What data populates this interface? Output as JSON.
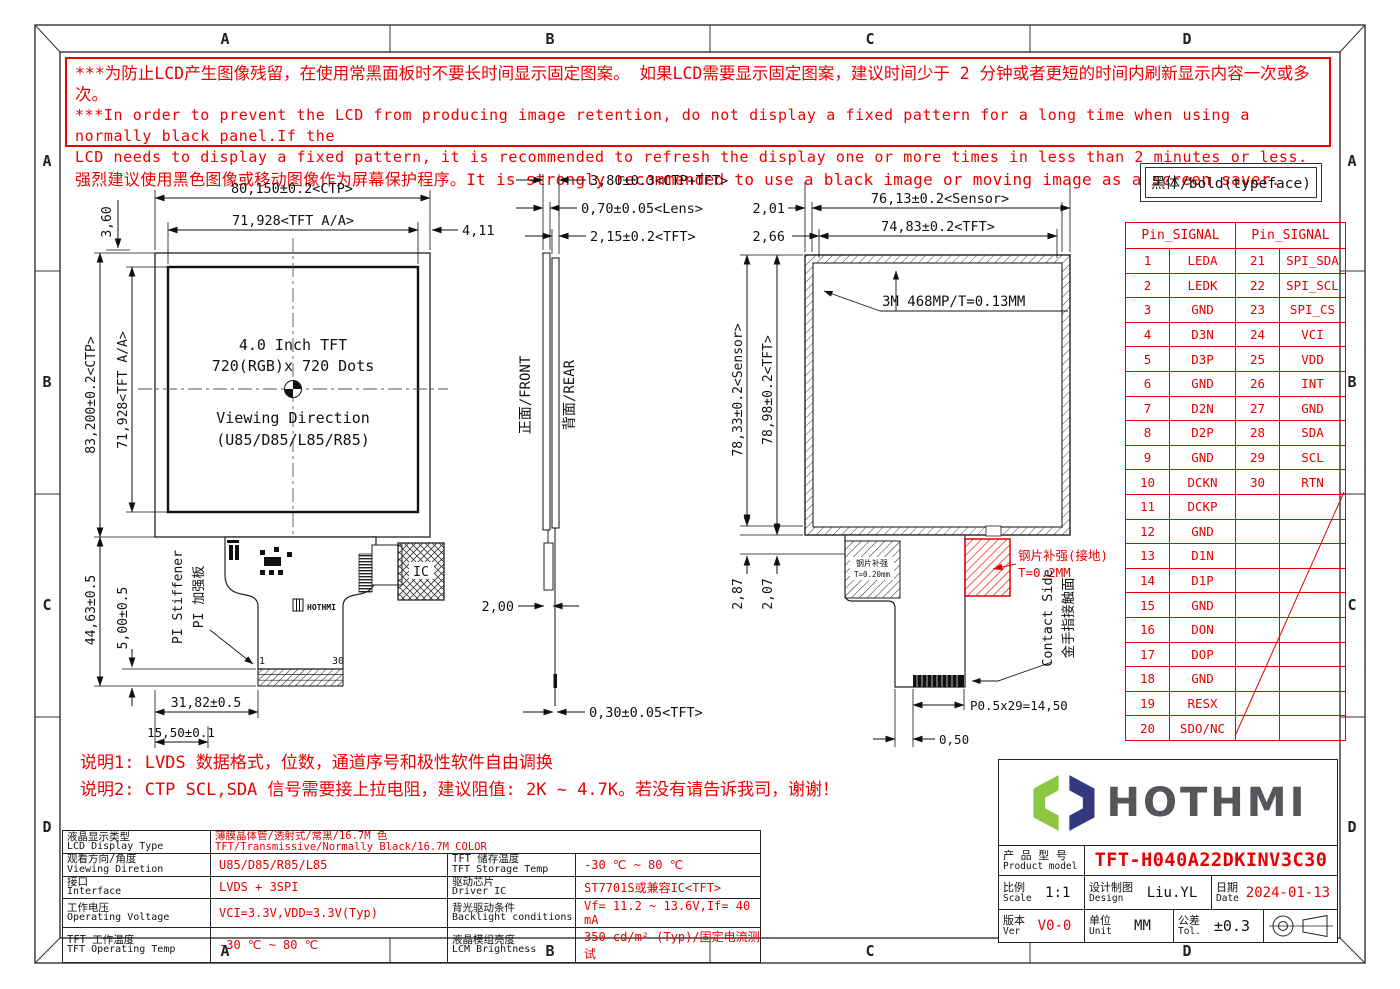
{
  "colors": {
    "red": "#e60000",
    "line": "#111111",
    "logo_green": "#8dc63f",
    "logo_navy": "#35387e",
    "logo_gray": "#55565a"
  },
  "zones": [
    "A",
    "B",
    "C",
    "D"
  ],
  "warning": {
    "lines": [
      "***为防止LCD产生图像残留，在使用常黑面板时不要长时间显示固定图案。 如果LCD需要显示固定图案，建议时间少于 2 分钟或者更短的时间内刷新显示内容一次或多次。",
      "***In order to prevent the LCD from producing image retention, do not display a fixed pattern for a long time when using a normally black panel.If the",
      "LCD needs to display a fixed pattern, it is recommended to refresh the display one or more times in less than 2 minutes or less.",
      "强烈建议使用黑色图像或移动图像作为屏幕保护程序。It is strongly recommended to use a black image or moving image as a screen saver."
    ]
  },
  "typeface_note": "黑体/bold(typeface)",
  "front_view": {
    "display_line1": "4.0 Inch TFT",
    "display_line2": "720(RGB)x 720 Dots",
    "viewing_line1": "Viewing Direction",
    "viewing_line2": "(U85/D85/L85/R85)",
    "stiffener_en": "PI Stiffener",
    "stiffener_cn": "PI 加强板",
    "fpc_logo": "HOTHMI",
    "ic_label": "IC",
    "pin_first": "1",
    "pin_last": "30",
    "dims": {
      "top_gap": "3,60",
      "ctp_w": "80,150±0.2<CTP>",
      "tft_w": "71,928<TFT A/A>",
      "right_off": "4,11",
      "ctp_h": "83,200±0.2<CTP>",
      "tft_h": "71,928<TFT A/A>",
      "tail_h": "44,63±0.5",
      "conn_h": "5,00±0.5",
      "tail_w": "31,82±0.5",
      "conn_off": "15,50±0.1"
    }
  },
  "side_view": {
    "front_label": "正面/FRONT",
    "rear_label": "背面/REAR",
    "dims": {
      "total": "3,80±0.3<CTP+TFT>",
      "lens": "0,70±0.05<Lens>",
      "tft": "2,15±0.2<TFT>",
      "stiffener": "2,00",
      "tail": "0,30±0.05<TFT>"
    }
  },
  "rear_view": {
    "tape_callout": "3M 468MP/T=0.13MM",
    "steel_inner_l1": "钢片补强",
    "steel_inner_l2": "T=0.20mm",
    "steel_label": "钢片补强(接地)",
    "steel_label2": "T=0.2MM",
    "contact_en": "Contact Side",
    "contact_cn": "金手指接触面",
    "dims": {
      "off1": "2,01",
      "off2": "2,66",
      "sensor_w": "76,13±0.2<Sensor>",
      "tft_w": "74,83±0.2<TFT>",
      "sensor_h": "78,33±0.2<Sensor>",
      "tft_h": "78,98±0.2<TFT>",
      "gap1": "2,87",
      "gap2": "2,07",
      "pitch": "P0.5x29=14,50",
      "edge": "0,50"
    }
  },
  "pin_table": {
    "header_left": "Pin_SIGNAL",
    "header_right": "Pin_SIGNAL",
    "rows": [
      {
        "no": "1",
        "signal": "LEDA",
        "no2": "21",
        "signal2": "SPI_SDA"
      },
      {
        "no": "2",
        "signal": "LEDK",
        "no2": "22",
        "signal2": "SPI_SCL"
      },
      {
        "no": "3",
        "signal": "GND",
        "no2": "23",
        "signal2": "SPI_CS"
      },
      {
        "no": "4",
        "signal": "D3N",
        "no2": "24",
        "signal2": "VCI"
      },
      {
        "no": "5",
        "signal": "D3P",
        "no2": "25",
        "signal2": "VDD"
      },
      {
        "no": "6",
        "signal": "GND",
        "no2": "26",
        "signal2": "INT"
      },
      {
        "no": "7",
        "signal": "D2N",
        "no2": "27",
        "signal2": "GND"
      },
      {
        "no": "8",
        "signal": "D2P",
        "no2": "28",
        "signal2": "SDA"
      },
      {
        "no": "9",
        "signal": "GND",
        "no2": "29",
        "signal2": "SCL"
      },
      {
        "no": "10",
        "signal": "DCKN",
        "no2": "30",
        "signal2": "RTN"
      },
      {
        "no": "11",
        "signal": "DCKP",
        "no2": "",
        "signal2": ""
      },
      {
        "no": "12",
        "signal": "GND",
        "no2": "",
        "signal2": ""
      },
      {
        "no": "13",
        "signal": "D1N",
        "no2": "",
        "signal2": ""
      },
      {
        "no": "14",
        "signal": "D1P",
        "no2": "",
        "signal2": ""
      },
      {
        "no": "15",
        "signal": "GND",
        "no2": "",
        "signal2": ""
      },
      {
        "no": "16",
        "signal": "DON",
        "no2": "",
        "signal2": ""
      },
      {
        "no": "17",
        "signal": "DOP",
        "no2": "",
        "signal2": ""
      },
      {
        "no": "18",
        "signal": "GND",
        "no2": "",
        "signal2": ""
      },
      {
        "no": "19",
        "signal": "RESX",
        "no2": "",
        "signal2": ""
      },
      {
        "no": "20",
        "signal": "SDO/NC",
        "no2": "",
        "signal2": ""
      }
    ]
  },
  "notes": [
    "说明1: LVDS 数据格式，位数，通道序号和极性软件自由调换",
    "说明2: CTP SCL,SDA 信号需要接上拉电阻，建议阻值: 2K ~ 4.7K。若没有请告诉我司，谢谢！"
  ],
  "spec_table": {
    "r1": {
      "l_cn": "液晶显示类型",
      "l_en": "LCD Display Type",
      "v_l1": "薄膜晶体管/透射式/常黑/16.7M 色",
      "v_l2": "TFT/Transmissive/Normally Black/16.7M COLOR"
    },
    "r2": {
      "l_cn": "观看方向/角度",
      "l_en": "Viewing Diretion",
      "v": "U85/D85/R85/L85",
      "r_cn": "TFT 储存温度",
      "r_en": "TFT Storage Temp",
      "rv": "-30 ℃ ~ 80 ℃"
    },
    "r3": {
      "l_cn": "接口",
      "l_en": "Interface",
      "v": "LVDS + 3SPI",
      "r_cn": "驱动芯片",
      "r_en": "Driver IC",
      "rv": "ST7701S或兼容IC<TFT>"
    },
    "r4": {
      "l_cn": "工作电压",
      "l_en": "Operating Voltage",
      "v": "VCI=3.3V,VDD=3.3V(Typ)",
      "r_cn": "背光驱动条件",
      "r_en": "Backlight conditions",
      "rv": "Vf= 11.2 ~ 13.6V,If= 40 mA"
    },
    "r5": {
      "l_cn": "TFT 工作温度",
      "l_en": "TFT Operating Temp",
      "v": "-30 ℃ ~ 80 ℃",
      "r_cn": "液晶模组亮度",
      "r_en": "LCM Brightness",
      "rv": "350 cd/m² (Typ)/固定电流测试"
    }
  },
  "title_block": {
    "logo_text": "HOTHMI",
    "product_label_cn": "产 品 型 号",
    "product_label_en": "Product model",
    "product_model": "TFT-H040A22DKINV3C30",
    "scale_cn": "比例",
    "scale_en": "Scale",
    "scale_val": "1:1",
    "design_cn": "设计制图",
    "design_en": "Design",
    "design_val": "Liu.YL",
    "date_cn": "日期",
    "date_en": "Date",
    "date_val": "2024-01-13",
    "ver_cn": "版本",
    "ver_en": "Ver",
    "ver_val": "V0-0",
    "unit_cn": "单位",
    "unit_en": "Unit",
    "unit_val": "MM",
    "tol_cn": "公差",
    "tol_en": "Tol.",
    "tol_val": "±0.3"
  }
}
